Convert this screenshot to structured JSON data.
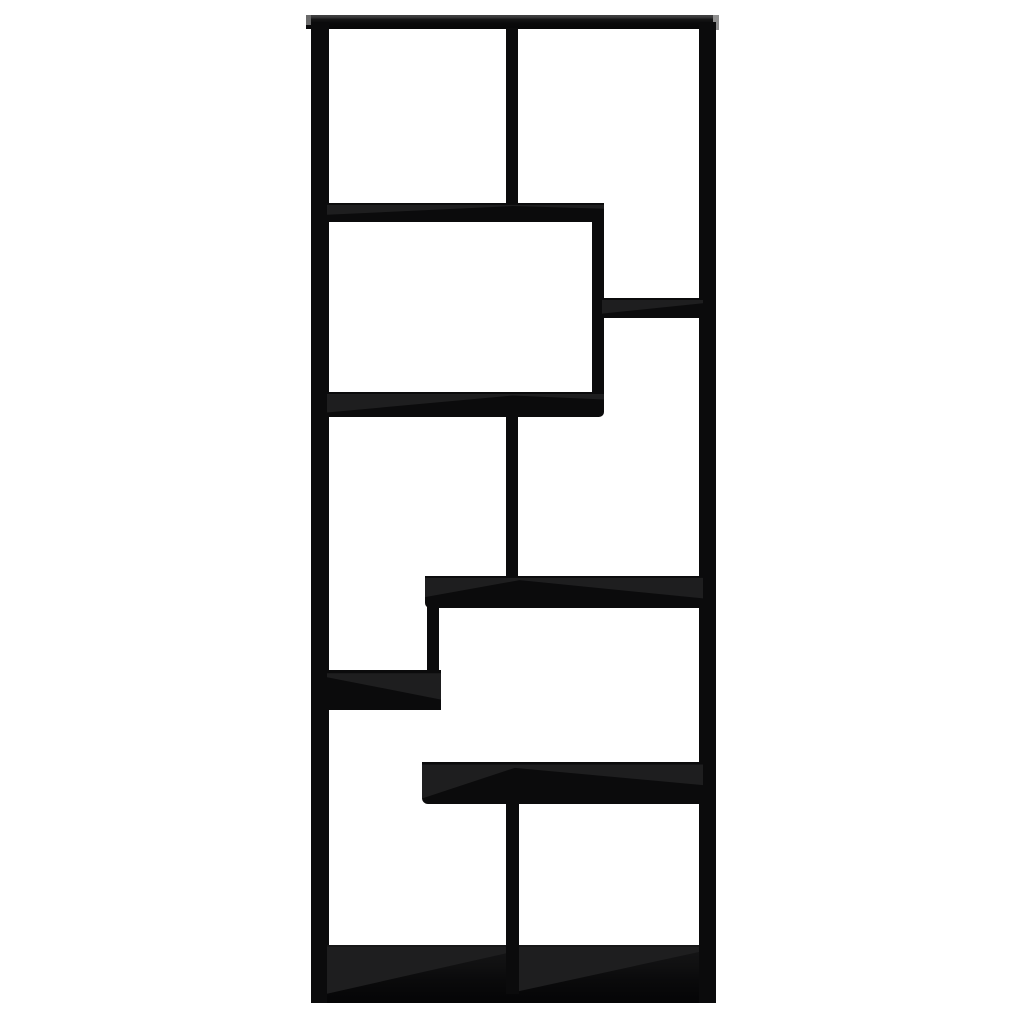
{
  "scene": {
    "type": "product-photo",
    "subject": "Black wooden geometric open bookcase / room divider with eight staggered compartments, straight front view on plain white background",
    "background_color": "#ffffff",
    "palette": {
      "board": "#0b0b0c",
      "board_surface": "#1e1e1f",
      "rail_edge_highlight": "#404041",
      "endcap_left": "#6a6a6a",
      "endcap_right": "#8f8f8f",
      "floor_top": "#161617",
      "floor_bottom": "#050506"
    }
  },
  "bookcase": {
    "bounds": {
      "x": 306,
      "y": 15,
      "width": 413,
      "height": 988
    },
    "compartment_count": 8,
    "parts": [
      {
        "name": "top-rail",
        "x": 306,
        "y": 15,
        "w": 413,
        "h": 14,
        "grad": "rail-grad"
      },
      {
        "name": "top-rail-left-endcap",
        "x": 306,
        "y": 15,
        "w": 5,
        "h": 10,
        "color": "#6a6a6a"
      },
      {
        "name": "top-rail-right-endcap",
        "x": 713,
        "y": 15,
        "w": 6,
        "h": 15,
        "color": "#8f8f8f"
      },
      {
        "name": "left-side-panel",
        "x": 311,
        "y": 22,
        "w": 18,
        "h": 981
      },
      {
        "name": "right-side-panel",
        "x": 699,
        "y": 22,
        "w": 17,
        "h": 981
      },
      {
        "name": "top-center-divider",
        "x": 506,
        "y": 28,
        "w": 12,
        "h": 176
      },
      {
        "name": "shelf-a",
        "x": 327,
        "y": 203,
        "w": 277,
        "h": 19,
        "wedge": "0% 10%, 100% 10%, 100% 30%, 67% 16%, 0% 62%",
        "radius": "0 0 4px 0"
      },
      {
        "name": "divider-under-shelf-a",
        "x": 592,
        "y": 218,
        "w": 12,
        "h": 176
      },
      {
        "name": "shelf-b",
        "x": 602,
        "y": 298,
        "w": 101,
        "h": 20,
        "wedge": "0% 10%, 100% 10%, 100% 26%, 0% 78%"
      },
      {
        "name": "shelf-c",
        "x": 327,
        "y": 392,
        "w": 277,
        "h": 25,
        "wedge": "0% 8%, 100% 8%, 100% 30%, 67% 14%, 0% 82%",
        "radius": "0 0 5px 0"
      },
      {
        "name": "mid-center-divider",
        "x": 506,
        "y": 415,
        "w": 12,
        "h": 163
      },
      {
        "name": "shelf-d",
        "x": 425,
        "y": 576,
        "w": 278,
        "h": 32,
        "wedge": "0% 6%, 100% 6%, 100% 70%, 34% 13%, 0% 66%",
        "radius": "0 0 0 5px"
      },
      {
        "name": "divider-under-shelf-d",
        "x": 427,
        "y": 606,
        "w": 12,
        "h": 100,
        "radius": "0 0 3px 3px"
      },
      {
        "name": "shelf-e",
        "x": 327,
        "y": 670,
        "w": 114,
        "h": 40,
        "wedge": "0% 8%, 100% 8%, 100% 74%, 0% 18%"
      },
      {
        "name": "shelf-f",
        "x": 422,
        "y": 762,
        "w": 281,
        "h": 42,
        "wedge": "0% 6%, 100% 6%, 100% 55%, 33% 14%, 0% 87%",
        "radius": "0 0 0 6px"
      },
      {
        "name": "bottom-panel",
        "x": 327,
        "y": 945,
        "w": 372,
        "h": 58,
        "grad": "floor-grad"
      },
      {
        "name": "bottom-panel-left-surface",
        "x": 327,
        "y": 945,
        "w": 180,
        "h": 58,
        "wedge": "0% 3%, 100% 3%, 100% 14%, 0% 84%",
        "transparent": true
      },
      {
        "name": "bottom-panel-right-surface",
        "x": 518,
        "y": 945,
        "w": 181,
        "h": 58,
        "wedge": "0% 3%, 100% 3%, 100% 12%, 0% 80%",
        "transparent": true
      },
      {
        "name": "bottom-center-divider",
        "x": 506,
        "y": 804,
        "w": 13,
        "h": 190
      }
    ]
  }
}
